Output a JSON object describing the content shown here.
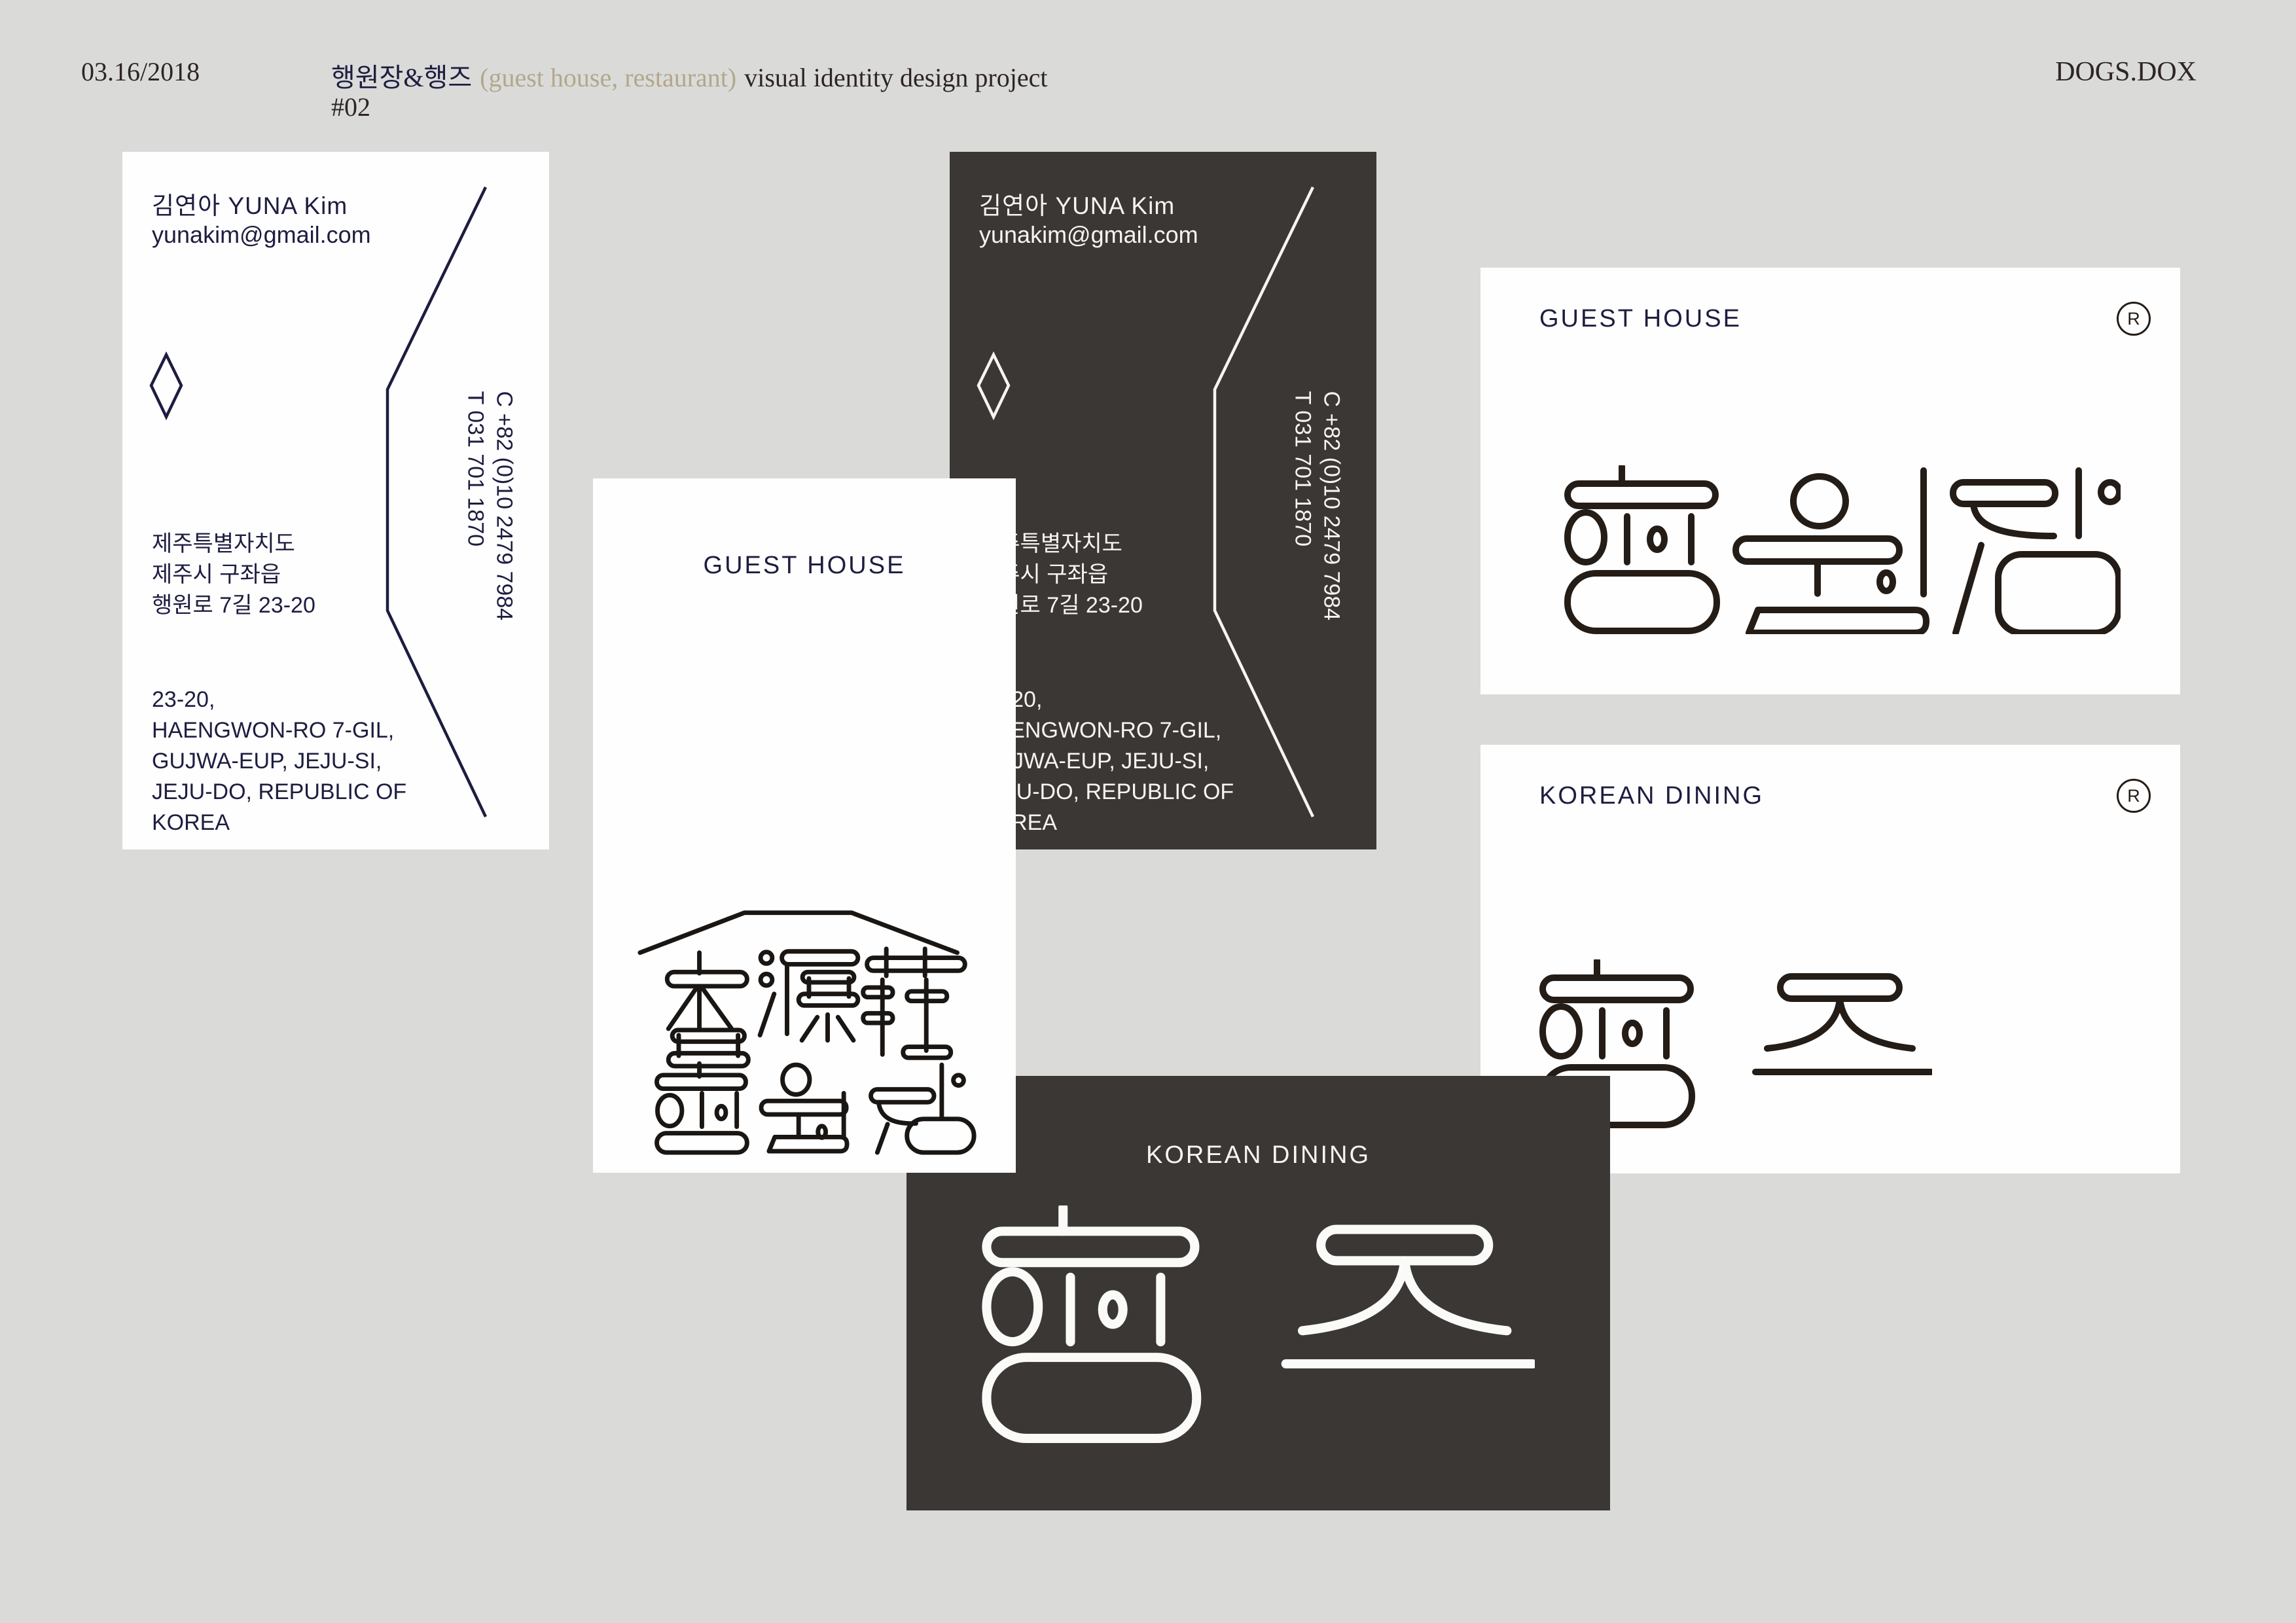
{
  "header": {
    "date": "03.16/2018",
    "project_kr": "행원장&행즈",
    "project_paren": "(guest house, restaurant)",
    "project_rest": "visual identity design project",
    "number": "#02",
    "studio": "DOGS.DOX"
  },
  "contact_card": {
    "name": "김연아 YUNA Kim",
    "email": "yunakim@gmail.com",
    "address_kr": [
      "제주특별자치도",
      "제주시 구좌읍",
      "행원로 7길 23-20"
    ],
    "address_en": [
      "23-20,",
      "HAENGWON-RO 7-GIL,",
      "GUJWA-EUP, JEJU-SI,",
      "JEJU-DO, REPUBLIC OF",
      "KOREA"
    ],
    "phone_mobile": "C +82 (0)10 2479 7984",
    "phone_office": "T 031 701 1870"
  },
  "logo_cards": {
    "guest_house_label": "GUEST HOUSE",
    "korean_dining_label": "KOREAN DINING",
    "registered": "R"
  },
  "colors": {
    "background": "#dadbd9",
    "card_white": "#fefefe",
    "card_dark": "#3b3734",
    "navy_text": "#1d1d40",
    "logo_ink": "#241c16",
    "tan_accent": "#b3a78c",
    "header_text": "#2d2524",
    "white_ink": "#fafaf8"
  }
}
